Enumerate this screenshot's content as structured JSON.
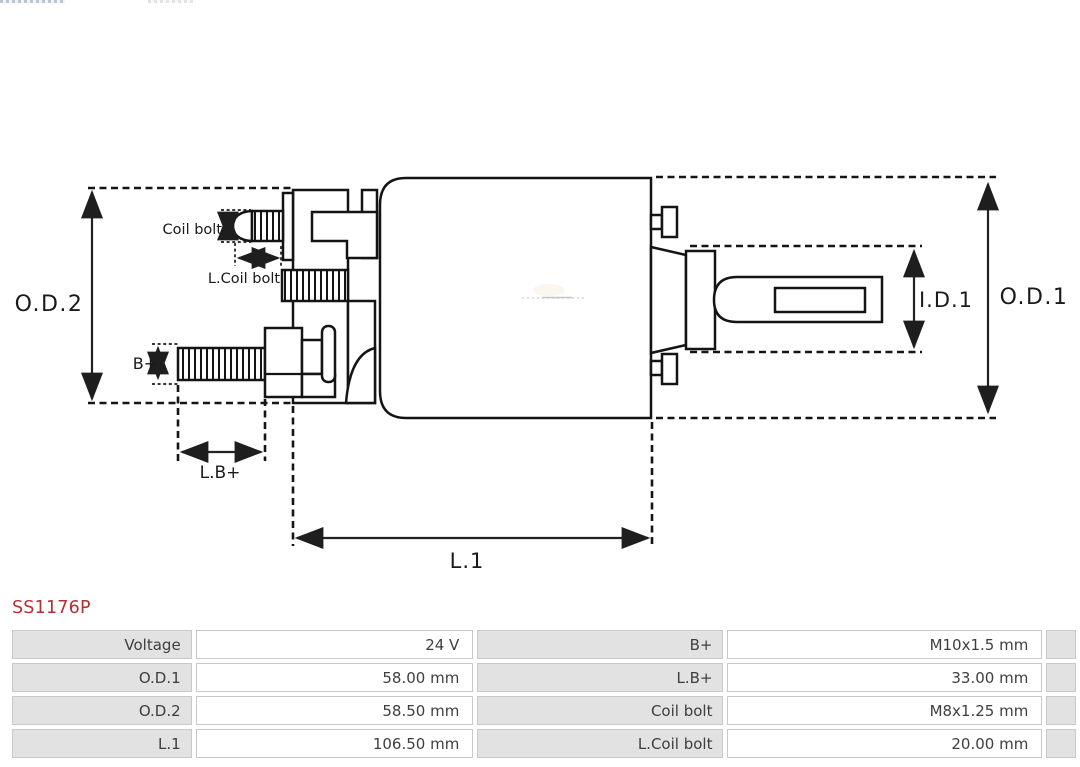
{
  "part_number": "SS1176P",
  "diagram": {
    "labels": {
      "od2": "O.D.2",
      "od1": "O.D.1",
      "id1": "I.D.1",
      "l1": "L.1",
      "lb_plus": "L.B+",
      "b_plus": "B+",
      "coil_bolt": "Coil bolt",
      "l_coil_bolt": "L.Coil bolt"
    }
  },
  "spec_table": {
    "rows": [
      {
        "label1": "Voltage",
        "value1": "24 V",
        "label2": "B+",
        "value2": "M10x1.5 mm"
      },
      {
        "label1": "O.D.1",
        "value1": "58.00 mm",
        "label2": "L.B+",
        "value2": "33.00 mm"
      },
      {
        "label1": "O.D.2",
        "value1": "58.50 mm",
        "label2": "Coil bolt",
        "value2": "M8x1.25 mm"
      },
      {
        "label1": "L.1",
        "value1": "106.50 mm",
        "label2": "L.Coil bolt",
        "value2": "20.00 mm"
      }
    ]
  },
  "colors": {
    "part_number_red": "#b23034",
    "table_label_bg": "#e2e2e2",
    "table_border": "#c9c9c9",
    "drawing_line": "#141414"
  }
}
